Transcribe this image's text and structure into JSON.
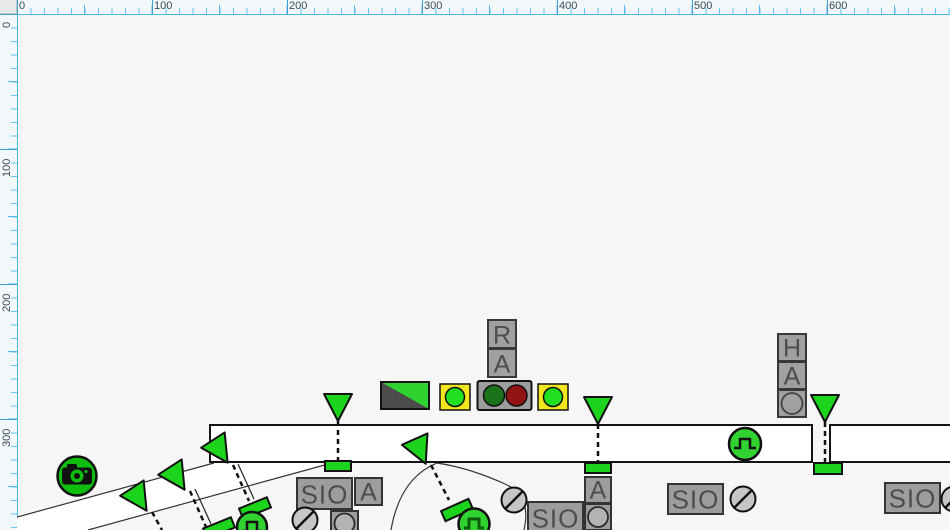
{
  "rulers": {
    "top": [
      "0",
      "100",
      "200",
      "300",
      "400",
      "500",
      "600"
    ],
    "left": [
      "0",
      "100",
      "200",
      "300"
    ]
  },
  "labels": {
    "r": "R",
    "a": "A",
    "h": "H",
    "sio": "SIO"
  },
  "colors": {
    "canvas_bg": "#f6f6f6",
    "ruler_bg": "#f2f7fa",
    "ruler_tick_blue": "#54b9e4",
    "canvas_border_blue": "#46b9e9",
    "signal_green": "#1bd41b",
    "camera_green": "#0fbf0f",
    "lamp_green_bright": "#20e020",
    "lamp_green_dark": "#1a731a",
    "lamp_red_dark": "#911414",
    "lamp_yellow": "#f2e71e",
    "box_gray": "#9e9e9e",
    "box_letter_gray": "#4d4d4d",
    "track_outline": "#141414"
  },
  "icons": {
    "camera-icon": "camera glyph in green circle",
    "pulse-icon": "square-wave in green circle",
    "no-entry-icon": "gray circle with diagonal slash",
    "signal-triangle-icon": "green triangle signal head",
    "signal-base-icon": "green rectangle signal base",
    "lamp-circle-icon": "round indicator lamp",
    "split-indicator-icon": "rectangle split diagonally dark/green"
  }
}
